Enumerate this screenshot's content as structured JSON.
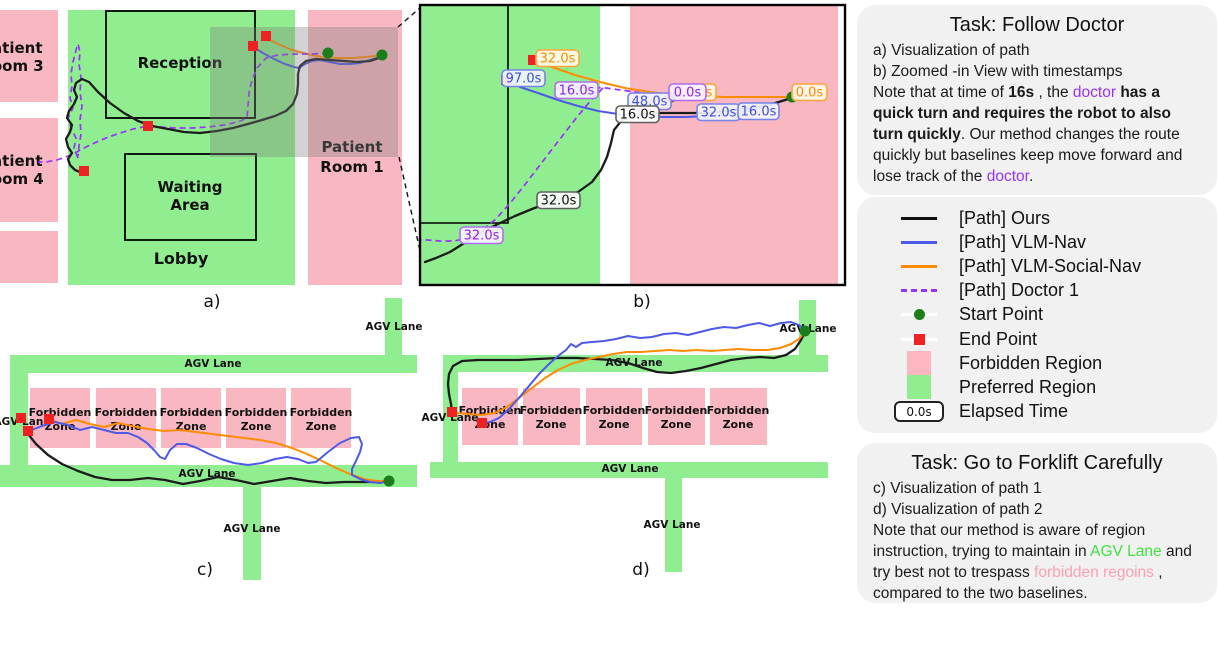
{
  "figure": {
    "panels": {
      "a": {
        "caption": "a)",
        "rooms": {
          "patient_room_3_line1": "Patient",
          "patient_room_3_line2": "Room 3",
          "patient_room_4_line1": "Patient",
          "patient_room_4_line2": "Room 4",
          "patient_room_1_line1": "Patient",
          "patient_room_1_line2": "Room 1",
          "reception": "Reception",
          "waiting_line1": "Waiting",
          "waiting_line2": "Area",
          "lobby": "Lobby"
        }
      },
      "b": {
        "caption": "b)",
        "timestamps": [
          {
            "label": "32.0s",
            "series": "VLM-Social-Nav"
          },
          {
            "label": "97.0s",
            "series": "VLM-Nav"
          },
          {
            "label": "16.0s",
            "series": "Doctor 1"
          },
          {
            "label": "48.0s",
            "series": "VLM-Nav"
          },
          {
            "label": "0.0s",
            "series": "VLM-Social-Nav"
          },
          {
            "label": "0.0s",
            "series": "Doctor 1"
          },
          {
            "label": "0.0s",
            "series": "VLM-Social-Nav"
          },
          {
            "label": "16.0s",
            "series": "Ours"
          },
          {
            "label": "32.0s",
            "series": "VLM-Nav"
          },
          {
            "label": "16.0s",
            "series": "VLM-Nav"
          },
          {
            "label": "32.0s",
            "series": "Ours"
          },
          {
            "label": "32.0s",
            "series": "Doctor 1"
          }
        ]
      },
      "c": {
        "caption": "c)",
        "agv_lane_label": "AGV Lane",
        "forbidden_zone_line1": "Forbidden",
        "forbidden_zone_line2": "Zone"
      },
      "d": {
        "caption": "d)",
        "agv_lane_label": "AGV Lane",
        "forbidden_zone_line1": "Forbidden",
        "forbidden_zone_line2": "Zone"
      }
    },
    "colors": {
      "forbidden_region": "#f8b7c1",
      "preferred_region": "#90ee90",
      "path_ours": "#1c1c1c",
      "path_vlm_nav": "#4d5ae8",
      "path_vlm_social_nav": "#ff8c00",
      "path_doctor": "#9b30ff",
      "start_point": "#1b7e1b",
      "end_point": "#ee2222"
    }
  },
  "task1": {
    "title": "Task: Follow Doctor",
    "line_a": "a) Visualization of path",
    "line_b": "b) Zoomed -in View with timestamps",
    "note": [
      "Note that at time of ",
      "16s",
      " , the ",
      "doctor",
      " has a quick turn and requires the robot to also turn quickly",
      ". Our method changes the route quickly but baselines keep move forward and lose track of the ",
      "doctor",
      "."
    ]
  },
  "legend": {
    "items": [
      {
        "label": "[Path] Ours"
      },
      {
        "label": "[Path] VLM-Nav"
      },
      {
        "label": "[Path] VLM-Social-Nav"
      },
      {
        "label": "[Path] Doctor 1"
      },
      {
        "label": "Start Point"
      },
      {
        "label": "End Point"
      },
      {
        "label": "Forbidden Region"
      },
      {
        "label": "Preferred Region"
      },
      {
        "label": "Elapsed Time"
      }
    ],
    "elapsed_badge": "0.0s"
  },
  "task2": {
    "title": "Task: Go to Forklift Carefully",
    "line_c": "c) Visualization of path 1",
    "line_d": "d) Visualization of path 2",
    "note": [
      "Note that our method is aware of region instruction, trying to maintain in ",
      "AGV Lane",
      " and try best not to trespass ",
      "forbidden regoins",
      " , compared to the two baselines."
    ]
  }
}
